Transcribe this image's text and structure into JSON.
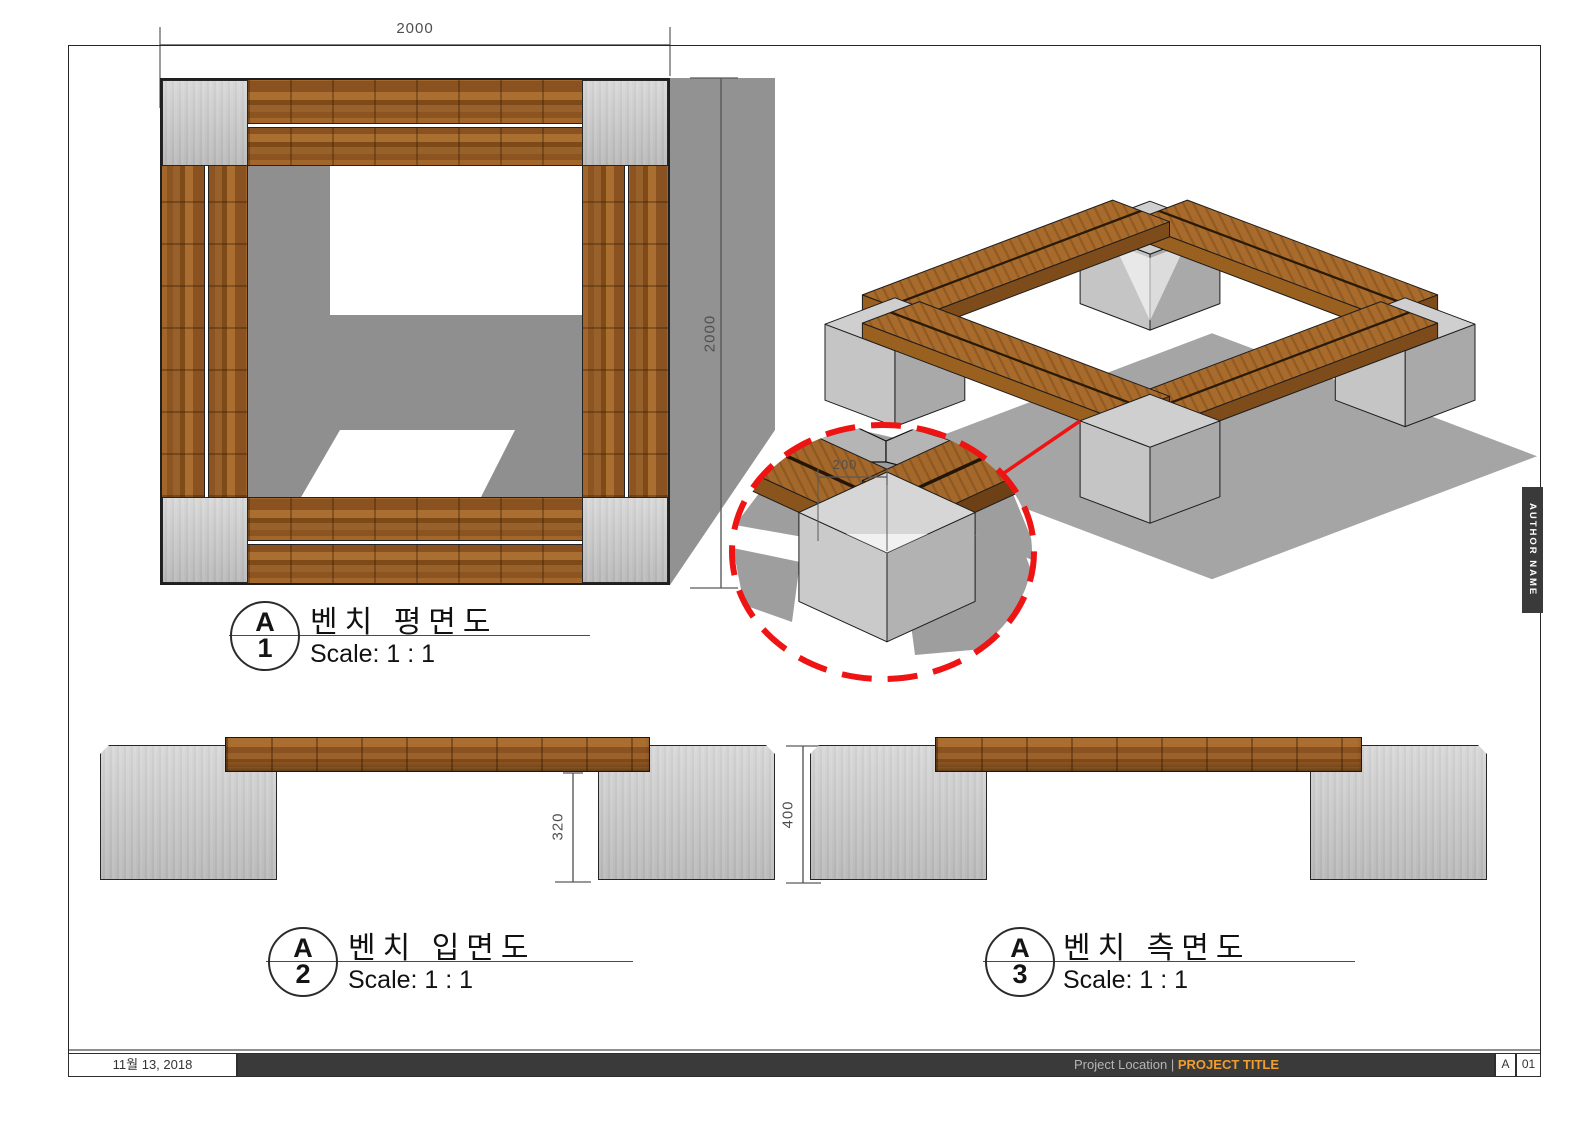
{
  "sheet": {
    "date": "11월 13, 2018",
    "project_location": "Project Location",
    "separator": "| ",
    "project_title": "PROJECT TITLE",
    "revision": "A",
    "page_number": "01",
    "author": "AUTHOR NAME"
  },
  "views": {
    "plan": {
      "marker_letter": "A",
      "marker_number": "1",
      "title": "벤치 평면도",
      "scale": "Scale:  1 : 1"
    },
    "front": {
      "marker_letter": "A",
      "marker_number": "2",
      "title": "벤치 입면도",
      "scale": "Scale:  1 : 1"
    },
    "side": {
      "marker_letter": "A",
      "marker_number": "3",
      "title": "벤치 측면도",
      "scale": "Scale:  1 : 1"
    }
  },
  "dimensions": {
    "plan_width": "2000",
    "plan_height": "2000",
    "detail_offset": "200",
    "front_clearance": "320",
    "side_height": "400"
  },
  "colors": {
    "accent_red": "#ee1414",
    "title_orange": "#f09e2e",
    "bar_charcoal": "#3a3a3a",
    "shadow_gray": "#a5a5a5",
    "wood_brown": "#8f5820",
    "concrete_gray": "#c8c8c8"
  }
}
